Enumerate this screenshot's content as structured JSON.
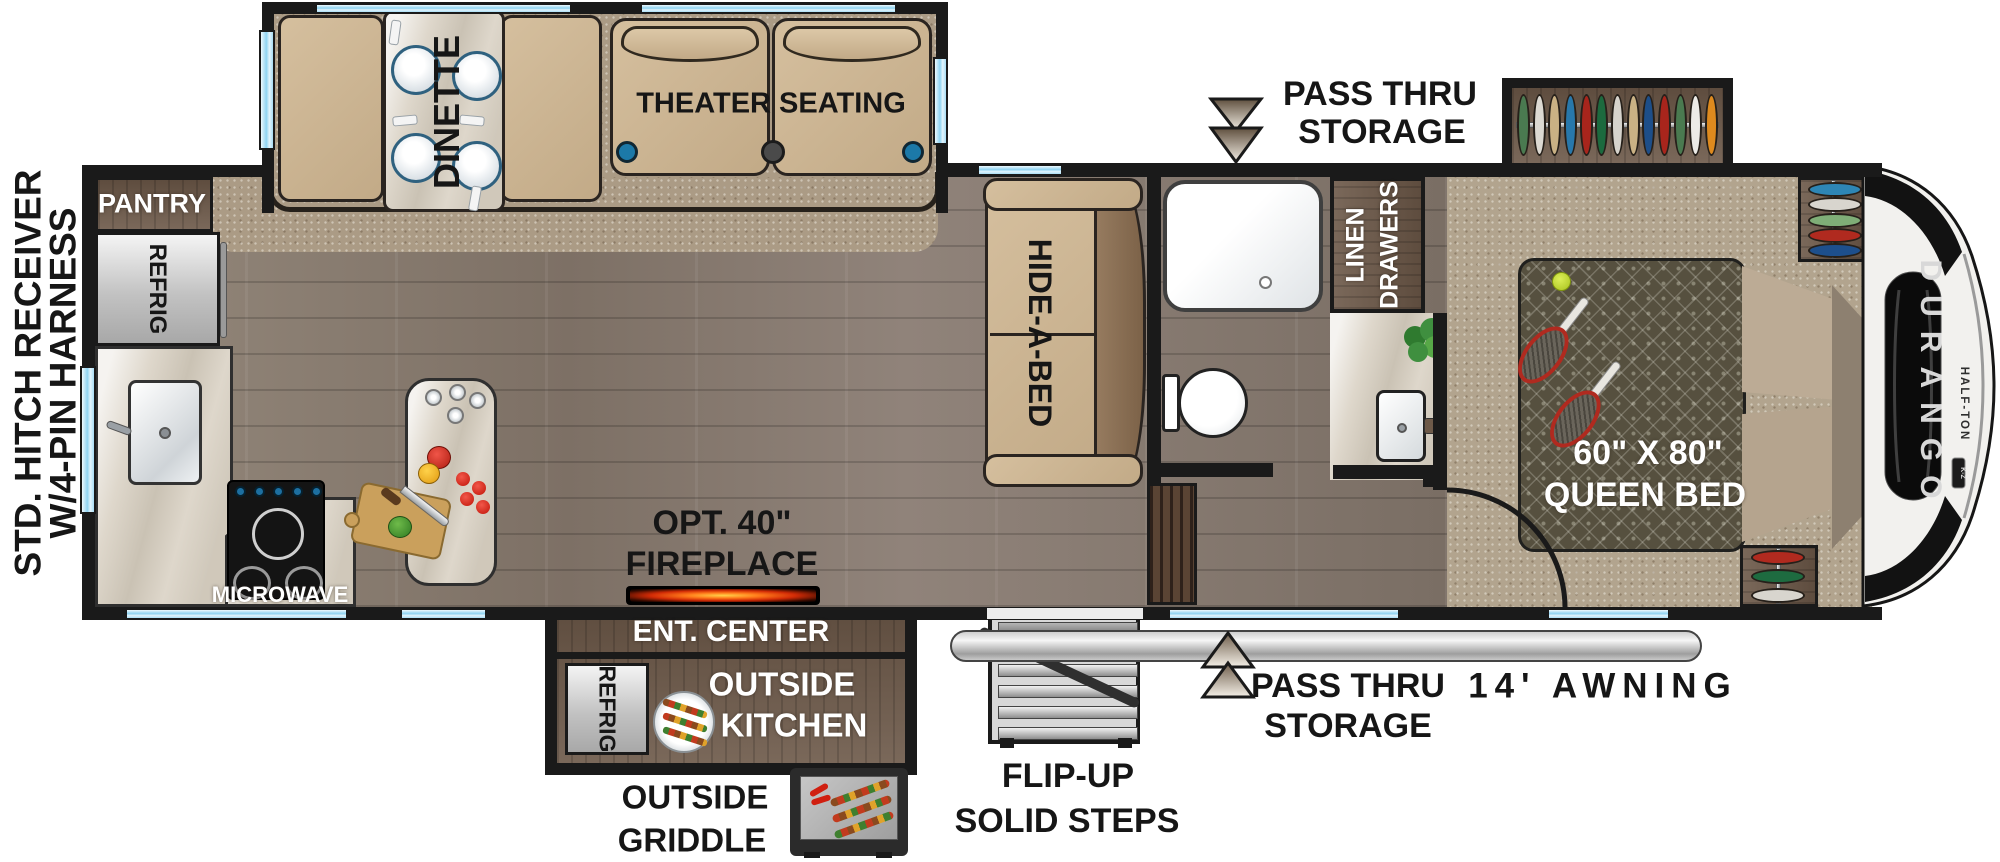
{
  "exterior": {
    "hitch_label_line1": "STD. HITCH RECEIVER",
    "hitch_label_line2": "W/4-PIN HARNESS",
    "pass_thru_top": {
      "line1": "PASS THRU",
      "line2": "STORAGE"
    },
    "pass_thru_bottom": {
      "line1": "PASS THRU",
      "line2": "STORAGE"
    },
    "awning_label": "14' AWNING",
    "steps_label": {
      "line1": "FLIP-UP",
      "line2": "SOLID STEPS"
    },
    "griddle_label": {
      "line1": "OUTSIDE",
      "line2": "GRIDDLE"
    }
  },
  "interior": {
    "pantry": "PANTRY",
    "refrigerator": "REFRIG",
    "dinette": "DINETTE",
    "theater_seating": "THEATER SEATING",
    "hide_a_bed": "HIDE-A-BED",
    "linen_drawers": {
      "line1": "LINEN",
      "line2": "DRAWERS"
    },
    "queen_bed": {
      "line1": "60\" X 80\"",
      "line2": "QUEEN BED"
    },
    "microwave": "MICROWAVE",
    "fireplace": {
      "line1": "OPT. 40\"",
      "line2": "FIREPLACE"
    },
    "ent_center": "ENT. CENTER"
  },
  "outside_kitchen": {
    "refrigerator": "REFRIG",
    "label": {
      "line1": "OUTSIDE",
      "line2": "KITCHEN"
    }
  },
  "branding": {
    "model": "DURANGO",
    "series": "HALF-TON",
    "badge": "K-Z"
  },
  "closets": {
    "bedroom_slide": [
      "#4a7a50",
      "#dcd9d2",
      "#c9b184",
      "#2878ab",
      "#a8251c",
      "#1c6a3e",
      "#d6d3cc",
      "#c9b184",
      "#1d4e89",
      "#a8251c",
      "#4a7a50",
      "#ecebe7",
      "#de8a1e"
    ],
    "front_right_top": [
      "#2e86b5",
      "#d8d5ce",
      "#7fae77",
      "#b02a1f",
      "#1d4f8c"
    ],
    "front_right_bottom": [
      "#b02a1f",
      "#1e6b40",
      "#d8d5ce"
    ]
  },
  "colors": {
    "wall": "#1a1a1a",
    "window_glass": "#8ed3f2",
    "furniture_tan": "#cbb392",
    "cabinet_wood": "#6b5747",
    "floor_wood": "#8a7d71",
    "carpet": "#ab9b85",
    "awning_silver": "#c9c9c9",
    "fireplace_glow": "#ff7a1a",
    "arrow_dark": "#5f4f3e",
    "arrow_light": "#efe9df"
  }
}
